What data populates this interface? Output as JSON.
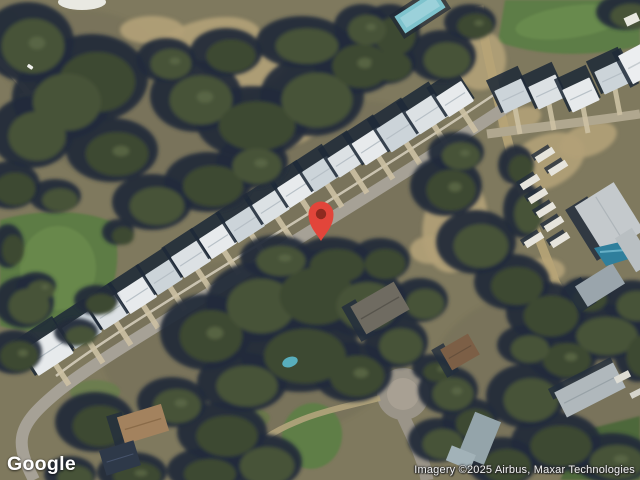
{
  "map": {
    "view": "satellite",
    "logo_text": "Google",
    "attribution": "Imagery ©2025 Airbus, Maxar Technologies",
    "pin": {
      "color": "#E2453A",
      "dot_color": "#8E2A1F"
    }
  }
}
